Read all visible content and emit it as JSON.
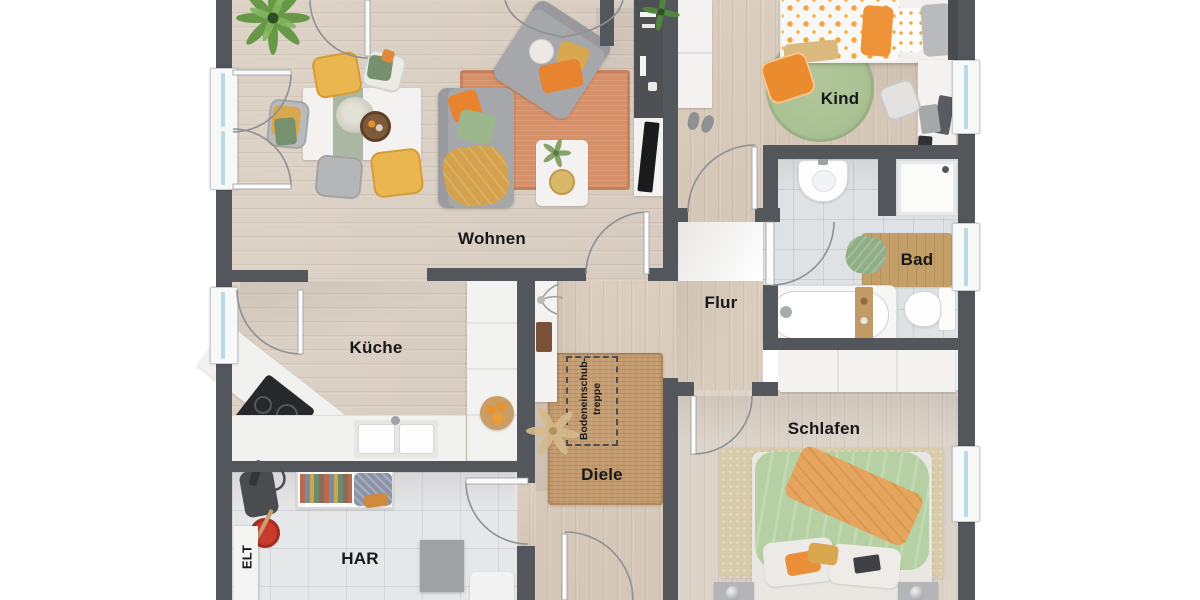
{
  "rooms": {
    "wohnen": {
      "label": "Wohnen"
    },
    "kueche": {
      "label": "Küche"
    },
    "har": {
      "label": "HAR"
    },
    "elt": {
      "label": "ELT"
    },
    "diele": {
      "label": "Diele"
    },
    "flur": {
      "label": "Flur"
    },
    "kind": {
      "label": "Kind"
    },
    "bad": {
      "label": "Bad"
    },
    "schlafen": {
      "label": "Schlafen"
    }
  },
  "annotations": {
    "attic_stairs": {
      "line1": "Bodeneinschub-",
      "line2": "treppe"
    }
  },
  "palette": {
    "wall": "#53565a",
    "wood": "#dbd0c3",
    "wood_warm": "#d9cbbb",
    "wood_light": "#dcd3c9",
    "tile_har": "#e6e7e9",
    "tile_bad": "#dfe2e5",
    "window_glass": "#b8d9e8",
    "rug_terracotta": "#d7916a",
    "rug_jute": "#c29a6d",
    "rug_green": "#a9c293",
    "accent_orange": "#e8842f",
    "accent_mustard": "#d9a84e",
    "accent_green": "#9cb78b",
    "accent_yellow": "#eab64f",
    "text": "#17181a"
  }
}
